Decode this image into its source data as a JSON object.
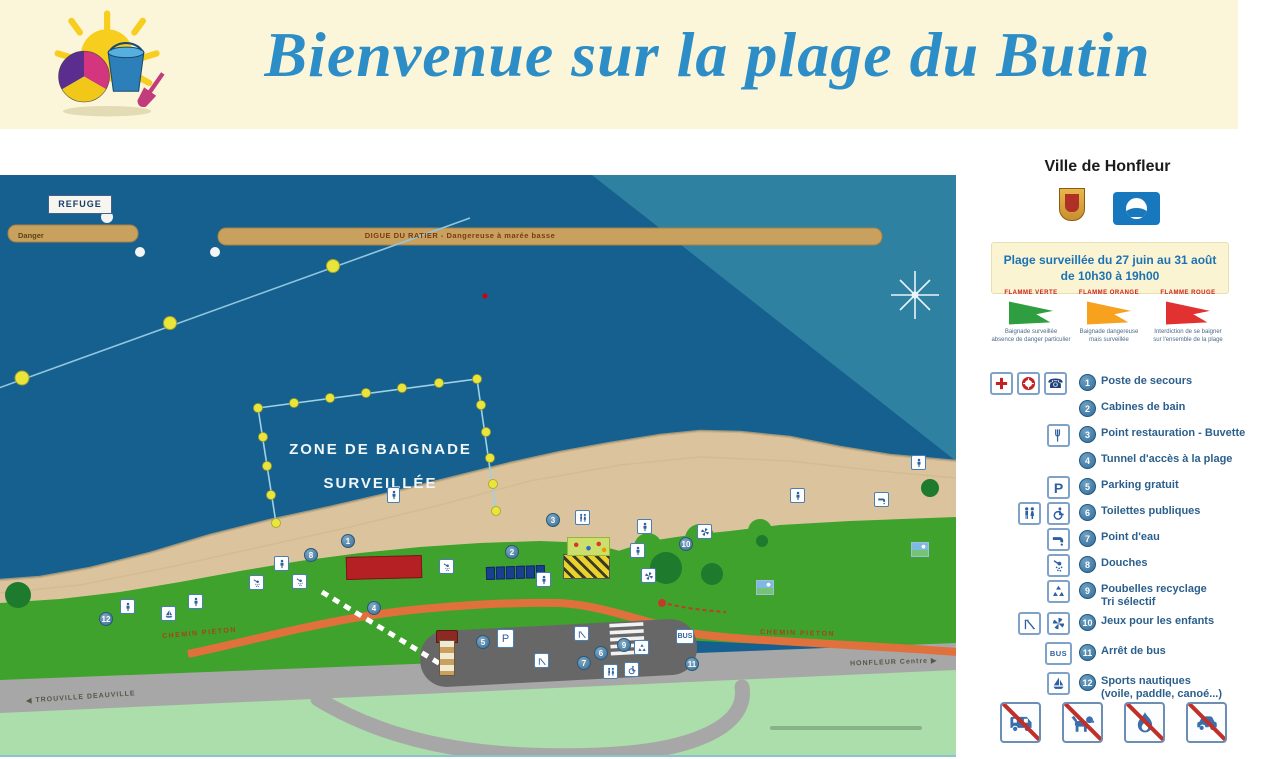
{
  "banner": {
    "title": "Bienvenue sur la plage du Butin"
  },
  "map": {
    "refuge_label": "REFUGE",
    "danger_label": "Danger",
    "dike_label": "DIGUE DU RATIER  -  Dangereuse à marée basse",
    "zone_label_line1": "ZONE DE BAIGNADE",
    "zone_label_line2": "SURVEILLÉE",
    "path_label_left": "CHEMIN PIETON",
    "path_label_right": "CHEMIN PIETON",
    "road_label_left": "TROUVILLE  DEAUVILLE",
    "road_label_right": "HONFLEUR Centre",
    "arrow_left": "◀",
    "arrow_right": "▶",
    "markers": [
      "1",
      "2",
      "3",
      "4",
      "5",
      "6",
      "7",
      "8",
      "9",
      "10",
      "11",
      "12"
    ],
    "icon_text": {
      "parking": "P",
      "bus": "BUS"
    }
  },
  "sidebar": {
    "city_title": "Ville de Honfleur",
    "surveillance_line1": "Plage surveillée du 27 juin au 31 août",
    "surveillance_line2": "de 10h30 à 19h00",
    "flags": [
      {
        "name": "FLAMME VERTE",
        "color": "#2F9E41",
        "caption_line1": "Baignade surveillée",
        "caption_line2": "absence de danger particulier"
      },
      {
        "name": "FLAMME ORANGE",
        "color": "#F6A21F",
        "caption_line1": "Baignade dangereuse",
        "caption_line2": "mais surveillée"
      },
      {
        "name": "FLAMME ROUGE",
        "color": "#E23131",
        "caption_line1": "Interdiction de se baigner",
        "caption_line2": "sur l'ensemble de la plage"
      }
    ],
    "legend": [
      {
        "num": "1",
        "label": "Poste de secours"
      },
      {
        "num": "2",
        "label": "Cabines de bain"
      },
      {
        "num": "3",
        "label": "Point restauration - Buvette"
      },
      {
        "num": "4",
        "label": "Tunnel d'accès à la plage"
      },
      {
        "num": "5",
        "label": "Parking gratuit"
      },
      {
        "num": "6",
        "label": "Toilettes publiques"
      },
      {
        "num": "7",
        "label": "Point d'eau"
      },
      {
        "num": "8",
        "label": "Douches"
      },
      {
        "num": "9",
        "label": "Poubelles recyclage",
        "label2": "Tri sélectif"
      },
      {
        "num": "10",
        "label": "Jeux pour les enfants"
      },
      {
        "num": "11",
        "label": "Arrêt de bus"
      },
      {
        "num": "12",
        "label": "Sports nautiques",
        "label2": "(voile, paddle, canoé...)"
      }
    ],
    "icon_text": {
      "parking": "P",
      "bus": "BUS",
      "phone": "☎"
    }
  },
  "colors": {
    "banner_bg": "#FBF6DA",
    "title_blue": "#2D8EC7",
    "sea": "#16608F",
    "sea_shallow": "#2F81A1",
    "sand": "#DBC49D",
    "grass": "#3EA22C",
    "lawn": "#ABDEAB",
    "road": "#A7A7A7",
    "path_orange": "#E0713C",
    "dike_tan": "#C9A15F",
    "flag_green": "#2F9E41",
    "flag_orange": "#F6A21F",
    "flag_red": "#E23131",
    "legend_blue": "#2B5F8C"
  }
}
